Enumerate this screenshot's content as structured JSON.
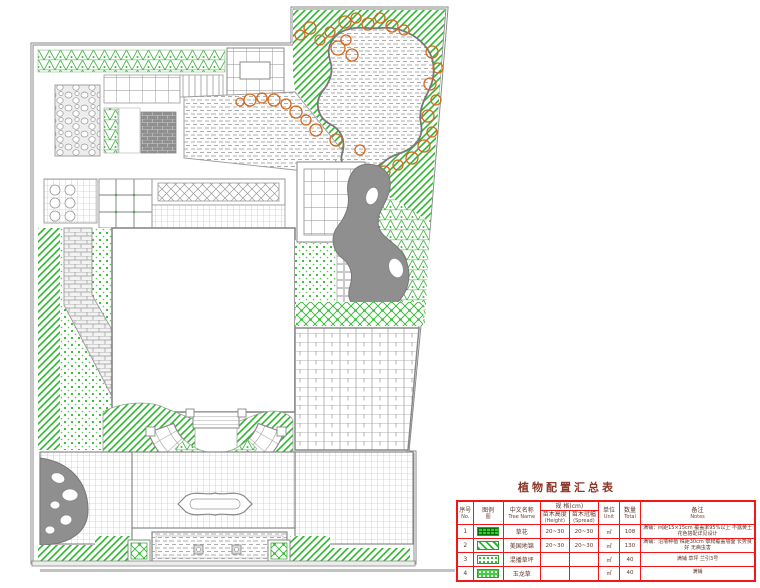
{
  "title": {
    "text": "植物配置汇总表"
  },
  "table": {
    "headers": {
      "no_cn": "序号",
      "no_en": "No.",
      "legend_cn": "图例",
      "legend_en": "图",
      "name_cn": "中文名称",
      "name_en": "Tree Name",
      "spec_cn": "规 格(cm)",
      "height_cn": "苗木高度",
      "height_en": "(Height)",
      "spread_cn": "苗木冠幅",
      "spread_en": "(Spread)",
      "unit_cn": "单位",
      "unit_en": "Unit",
      "total_cn": "数量",
      "total_en": "Total",
      "notes_cn": "备注",
      "notes_en": "Notes"
    },
    "rows": [
      {
        "no": "1",
        "legend_pattern": "green-grid-hatch",
        "name": "草花",
        "height": "20~30",
        "spread": "20~30",
        "unit": "㎡",
        "total": "108",
        "notes": "满铺：间距15×15cm 覆盖率95%以上 不露黄土 花色搭配详见设计"
      },
      {
        "no": "2",
        "legend_pattern": "green-diagonal-stripes",
        "name": "美国地锦",
        "height": "20~30",
        "spread": "20~30",
        "unit": "㎡",
        "total": "130",
        "notes": "满铺：沿墙种植 株距30cm 攀爬覆盖墙面 长势良好 无病虫害"
      },
      {
        "no": "3",
        "legend_pattern": "green-dot-hatch",
        "name": "混播草坪",
        "height": "",
        "spread": "",
        "unit": "㎡",
        "total": "40",
        "notes": "满铺 草坪 兰引3号"
      },
      {
        "no": "4",
        "legend_pattern": "green-x-hatch",
        "name": "玉龙草",
        "height": "",
        "spread": "",
        "unit": "㎡",
        "total": "40",
        "notes": "满铺"
      }
    ]
  },
  "plan": {
    "colors": {
      "planting_green": "#2eb82e",
      "rock_orange": "#d2691e",
      "paving_gray": "#9a9a9a",
      "dark_fill": "#8f8f8f",
      "table_line_red": "#f21616",
      "title_text": "#8b3626"
    },
    "features": [
      "north-lawn-band",
      "pond",
      "pond-rock-edging",
      "gravel-plaza",
      "north-pavilion",
      "cobble-paving",
      "trellis-walk",
      "grid-plaza",
      "stone-path",
      "courtyard",
      "east-pavilion",
      "stone-stream",
      "east-deck",
      "amphitheater-steps",
      "ornamental-pool",
      "boulder-feature",
      "water-channel",
      "planter-boxes",
      "hedge-strips"
    ]
  }
}
